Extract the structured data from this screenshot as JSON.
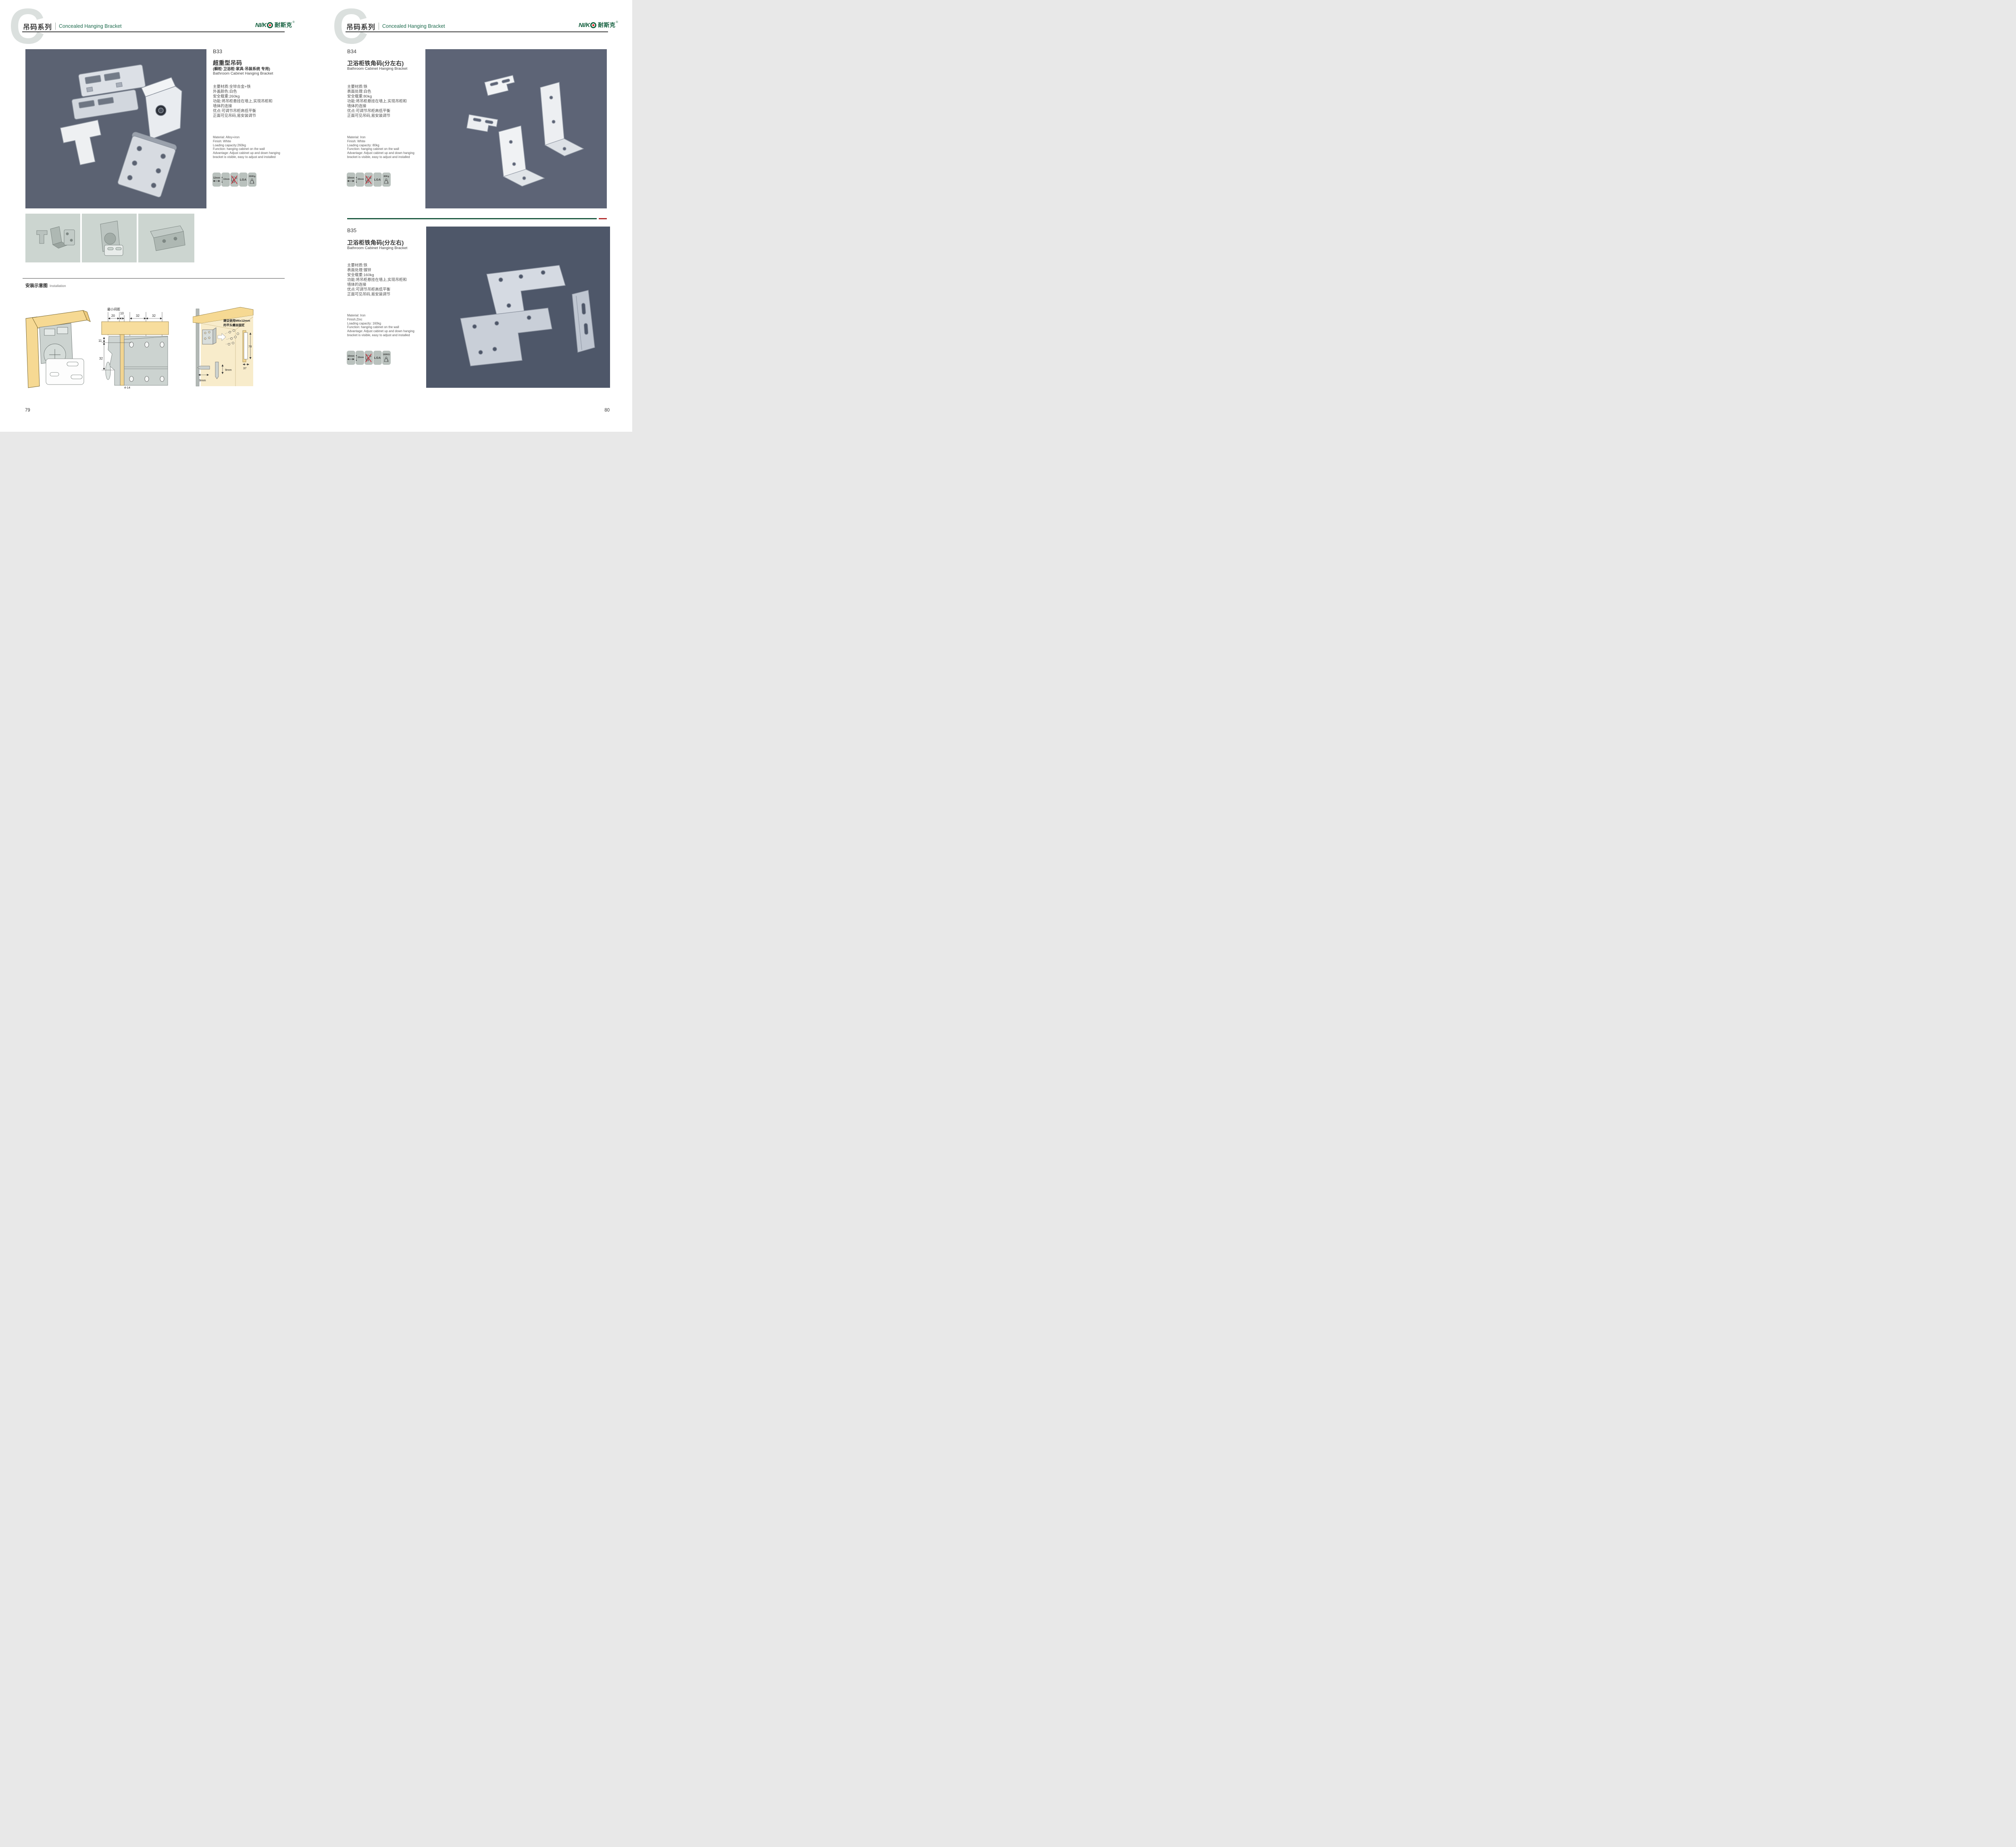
{
  "header": {
    "watermark": "C",
    "series_cn": "吊码系列",
    "series_en": "Concealed Hanging Bracket"
  },
  "logo": {
    "latin_a": "NI",
    "slash": "/",
    "latin_b": "K",
    "cn": "耐斯克",
    "reg": "®"
  },
  "products": [
    {
      "code": "B33",
      "name_cn": "超重型吊码",
      "name_note": "(橱柜·卫浴柜·家具·吊装系统 专用)",
      "name_en": "Bathroom Cabinet Hanging Bracket",
      "specs_cn": "主要材质:全锌合金+铁\n外盖颜色:白色\n安全载重:260kg\n功能:将吊柜悬挂在墙上,实现吊柜和\n墙体的连接\n优点:可调节吊柜高低平衡\n正面可见吊码,易安装调节",
      "specs_en": "Material: Alloy+iron\nFinish: White\nLoading capacity:260kg\nFunction: hanging cabinet on the wall\nAdvantage: Adjust cabinet up and down hanging\nbracket is visible, easy to adjust and installed",
      "icons": [
        {
          "type": "h-range-icon",
          "label": "12mm"
        },
        {
          "type": "v-range-icon",
          "label": "13mm"
        },
        {
          "type": "no-drill-icon",
          "label": ""
        },
        {
          "type": "cert-icon",
          "label": "LGA"
        },
        {
          "type": "weight-icon",
          "label": "260Kg"
        }
      ]
    },
    {
      "code": "B34",
      "name_cn": "卫浴柜铁角码(分左右)",
      "name_en": "Bathroom Cabinet Hanging Bracket",
      "specs_cn": "主要材质:铁\n表面处理:白色\n安全载重:80kg\n功能:将吊柜悬挂在墙上,实现吊柜和\n墙体的连接\n优点:可调节吊柜高低平衡\n正面可见吊码,易安装调节",
      "specs_en": "Material: Iron\nFinish: White\nLoading capacity: 80kg\nFunction: hanging cabinet on the wall\nAdvantage: Adjust cabinet up and down hanging\nbracket is visible, easy to adjust and installed",
      "icons": [
        {
          "type": "h-range-icon",
          "label": "10mm"
        },
        {
          "type": "v-range-icon",
          "label": "15mm"
        },
        {
          "type": "no-drill-icon",
          "label": ""
        },
        {
          "type": "cert-icon",
          "label": "LGA"
        },
        {
          "type": "weight-icon",
          "label": "80Kg"
        }
      ]
    },
    {
      "code": "B35",
      "name_cn": "卫浴柜铁角码(分左右)",
      "name_en": "Bathroom Cabinet Hanging Bracket",
      "specs_cn": "主要材质:铁\n表面处理:镀锌\n安全载重:160kg\n功能:将吊柜悬挂在墙上,实现吊柜和\n墙体的连接\n优点:可调节吊柜高低平衡\n正面可见吊码,易安装调节",
      "specs_en": "Material: Iron\nFinish:Zinc\nLoading capacity: 160kg\nFunction: hanging cabinet on the wall\nAdvantage: Adjust cabinet up and down hanging\nbracket is visible, easy to adjust and installed",
      "icons": [
        {
          "type": "h-range-icon",
          "label": "10mm"
        },
        {
          "type": "v-range-icon",
          "label": "15mm"
        },
        {
          "type": "no-drill-icon",
          "label": ""
        },
        {
          "type": "cert-icon",
          "label": "LGA"
        },
        {
          "type": "weight-icon",
          "label": "160KG"
        }
      ]
    }
  ],
  "installation": {
    "title_cn": "安装示意图",
    "title_en": "Installation",
    "mid": {
      "min_gap": "最小间距",
      "d20": "20",
      "d10": "10",
      "d32a": "32",
      "d32b": "32",
      "d11": "11",
      "d32c": "32",
      "d4_14": "4-14"
    },
    "right": {
      "note1": "建议使用M6x12mm",
      "note2": "的平头螺丝固定",
      "d78": "78",
      "d37": "37",
      "d9a": "9mm",
      "d9b": "9mm"
    }
  },
  "pages": {
    "left": "79",
    "right": "80"
  },
  "colors": {
    "accent_green": "#1e6b4e",
    "logo_green": "#14603f",
    "divider_green": "#1d5a41",
    "divider_red": "#b22d2d",
    "photo_bg": "#5b6272"
  }
}
